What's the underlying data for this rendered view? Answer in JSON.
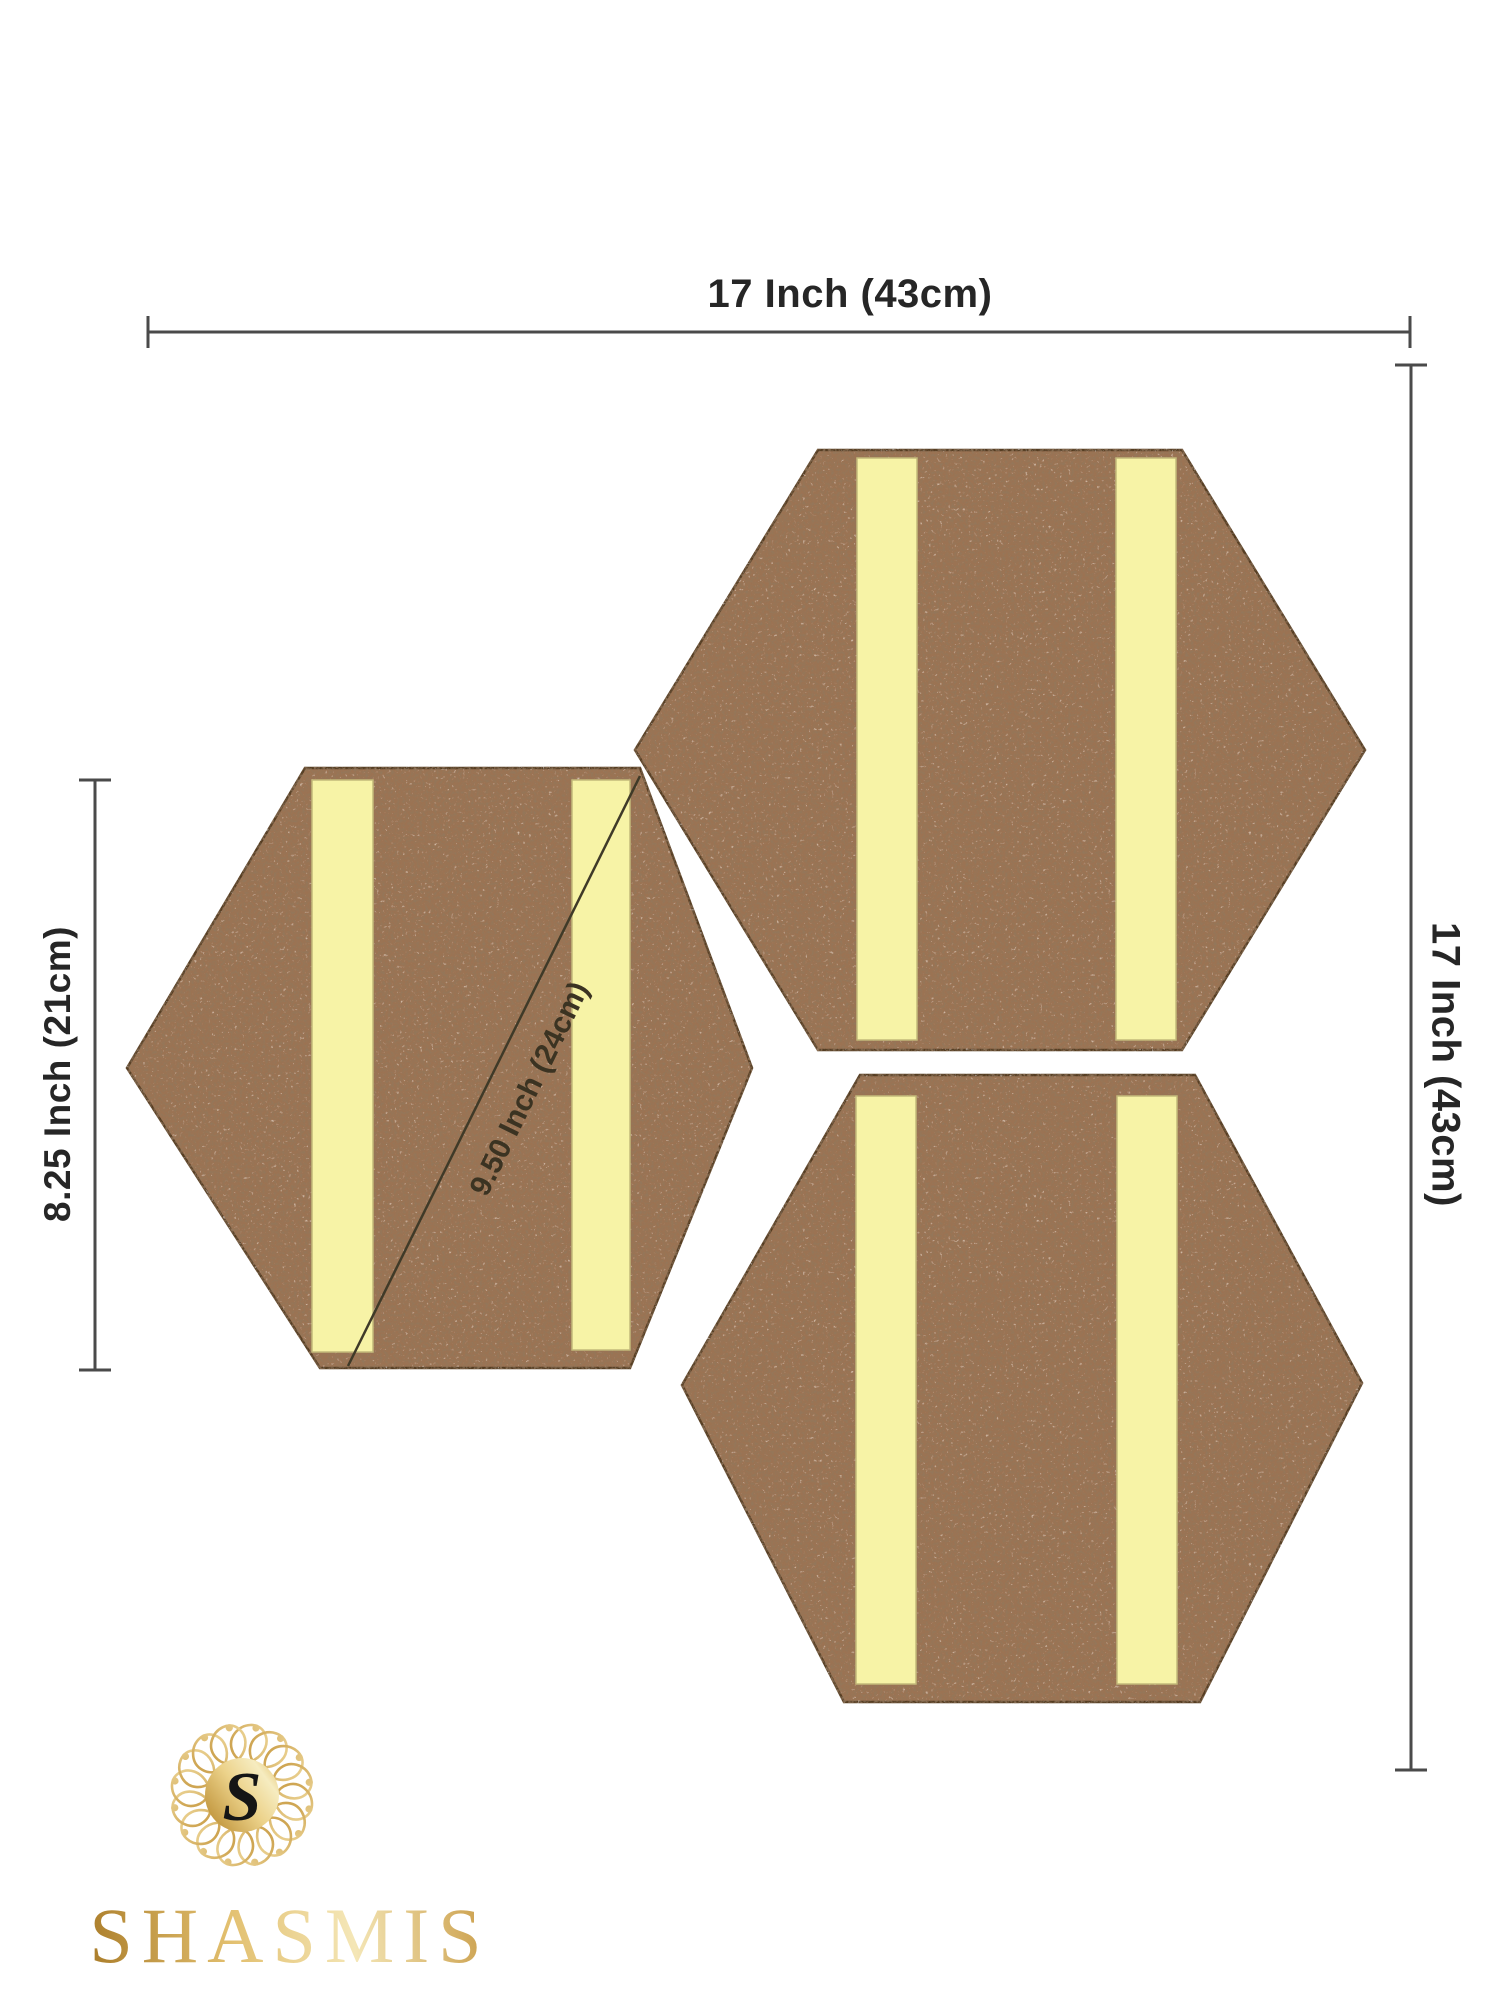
{
  "dimensions": {
    "top_width_label": "17 Inch (43cm)",
    "right_height_label": "17 Inch (43cm)",
    "left_height_label": "8.25 Inch (21cm)",
    "diagonal_label": "9.50 Inch (24cm)"
  },
  "logo": {
    "brand": "SHASMIS",
    "monogram": "S"
  },
  "colors": {
    "background": "#ffffff",
    "cork_base": "#9b7352",
    "cork_speckle_dark": "#4a2f1b",
    "cork_speckle_light": "#c9a88a",
    "hexagon_outline": "#553c24",
    "strip_yellow": "#f7f3a6",
    "strip_edge": "#c3b97a",
    "dimension_line": "#4a4a4a",
    "dimension_text": "#262626",
    "diagonal_line": "#3f3a28",
    "logo_gold_dark": "#a87c2c",
    "logo_gold_light": "#f2e2ac",
    "logo_monogram": "#151515"
  }
}
